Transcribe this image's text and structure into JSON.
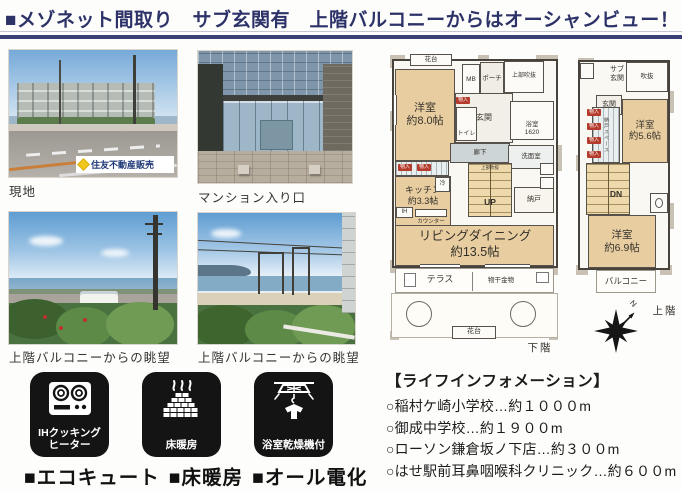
{
  "header": {
    "title": "■メゾネット間取り　サブ玄関有　上階バルコニーからはオーシャンビュー！"
  },
  "photos": [
    {
      "caption": "現地",
      "watermark": "住友不動産販売"
    },
    {
      "caption": "マンション入り口"
    },
    {
      "caption": "上階バルコニーからの眺望"
    },
    {
      "caption": "上階バルコニーからの眺望"
    }
  ],
  "features": [
    {
      "label": "IHクッキング\nヒーター"
    },
    {
      "label": "床暖房"
    },
    {
      "label": "浴室乾燥機付"
    }
  ],
  "equipment": {
    "items": [
      "■エコキュート",
      "■床暖房",
      "■オール電化"
    ]
  },
  "floorplan_lower": {
    "hanadai_top": "花台",
    "mb": "MB",
    "porch": "ポーチ",
    "upper_void": "上部吹抜",
    "bedroom8": "洋室\n約8.0帖",
    "genkan": "玄関",
    "toilet": "トイレ",
    "bath": "浴室\n1620",
    "hallway": "廊下",
    "washroom": "洗面室",
    "kitchen": "キッチン\n約3.3帖",
    "fridge": "冷",
    "ih": "IH",
    "counter": "カウンター",
    "stairs_up": "UP",
    "stairs_note": "上部吹抜",
    "storage": "納戸",
    "living": "リビングダイニング\n約13.5帖",
    "terrace": "テラス",
    "laundry_pole": "物干金物",
    "hanadai_bottom": "花台",
    "floor_label": "下階",
    "closet_tag": "物入"
  },
  "floorplan_upper": {
    "sub_genkan": "サブ\n玄関",
    "void": "吹抜",
    "genkan": "玄関",
    "bedroom56": "洋室\n約5.6帖",
    "closet_space": "納戸スペース",
    "stairs_dn": "DN",
    "bedroom69": "洋室\n約6.9帖",
    "balcony": "バルコニー",
    "floor_label": "上階",
    "compass_n": "N",
    "closet_tag": "物入"
  },
  "life_info": {
    "title": "【ライフインフォメーション】",
    "items": [
      "○稲村ケ崎小学校…約１０００m",
      "○御成中学校…約１９００m",
      "○ローソン鎌倉坂ノ下店…約３００m",
      "○はせ駅前耳鼻咽喉科クリニック…約６００m"
    ]
  },
  "colors": {
    "accent_navy": "#3a3f76",
    "room_tan": "#e8cda1",
    "tag_red": "#b43a2c",
    "logo_yellow": "#f2c71d"
  }
}
